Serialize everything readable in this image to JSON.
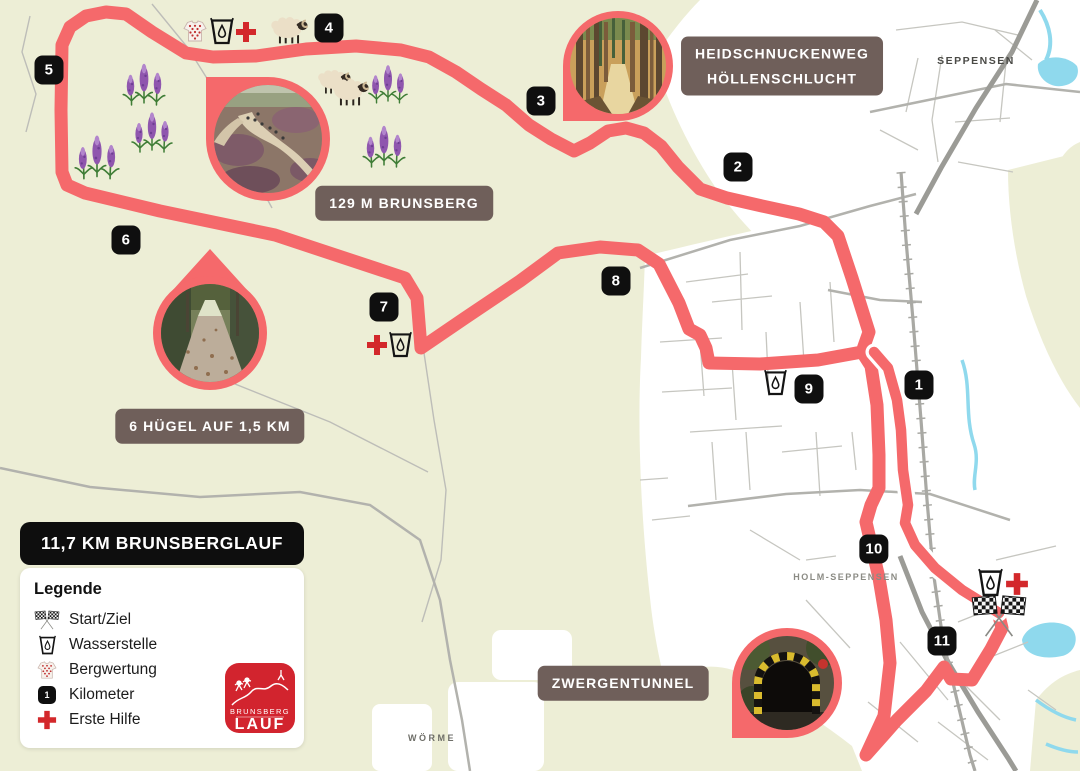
{
  "map": {
    "title_label": "11,7 KM BRUNSBERGLAUF",
    "legend": {
      "heading": "Legende",
      "km_sample": "1",
      "items": [
        {
          "icon": "start-finish-flags",
          "label": "Start/Ziel"
        },
        {
          "icon": "water-station",
          "label": "Wasserstelle"
        },
        {
          "icon": "mountain-jersey",
          "label": "Bergwertung"
        },
        {
          "icon": "kilometer-marker",
          "label": "Kilometer"
        },
        {
          "icon": "first-aid",
          "label": "Erste Hilfe"
        }
      ]
    },
    "logo": {
      "line1": "BRUNSBERG",
      "line2": "LAUF"
    },
    "labels": [
      {
        "name": "label-heidschnuckenweg",
        "lines": [
          "HEIDSCHNUCKENWEG",
          "HÖLLENSCHLUCHT"
        ],
        "cx": 782,
        "cy": 66
      },
      {
        "name": "label-brunsberg-summit",
        "lines": [
          "129 M BRUNSBERG"
        ],
        "cx": 404,
        "cy": 203
      },
      {
        "name": "label-huegel",
        "lines": [
          "6 HÜGEL AUF 1,5 KM"
        ],
        "cx": 210,
        "cy": 426
      },
      {
        "name": "label-zwergentunnel",
        "lines": [
          "ZWERGENTUNNEL"
        ],
        "cx": 623,
        "cy": 683
      }
    ],
    "places": [
      {
        "text": "SEPPENSEN",
        "x": 976,
        "y": 61,
        "size": 10.5,
        "spacing": 1.5,
        "color": "#4a4a46"
      },
      {
        "text": "HOLM-SEPPENSEN",
        "x": 846,
        "y": 577,
        "size": 9,
        "spacing": 1.5,
        "color": "#8b8b84"
      },
      {
        "text": "WÖRME",
        "x": 432,
        "y": 738,
        "size": 9,
        "spacing": 2.5,
        "color": "#6e6e68"
      }
    ],
    "km_markers": [
      {
        "label": "1",
        "x": 919,
        "y": 385
      },
      {
        "label": "2",
        "x": 738,
        "y": 167
      },
      {
        "label": "3",
        "x": 541,
        "y": 101
      },
      {
        "label": "4",
        "x": 329,
        "y": 28
      },
      {
        "label": "5",
        "x": 49,
        "y": 70
      },
      {
        "label": "6",
        "x": 126,
        "y": 240
      },
      {
        "label": "7",
        "x": 384,
        "y": 307
      },
      {
        "label": "8",
        "x": 616,
        "y": 281
      },
      {
        "label": "9",
        "x": 809,
        "y": 389
      },
      {
        "label": "10",
        "x": 874,
        "y": 549
      },
      {
        "label": "11",
        "x": 942,
        "y": 641
      }
    ],
    "icons": [
      {
        "type": "mountain-jersey",
        "x": 195,
        "y": 31,
        "s": 24
      },
      {
        "type": "water-station",
        "x": 222,
        "y": 31,
        "s": 24
      },
      {
        "type": "first-aid",
        "x": 246,
        "y": 32,
        "s": 22
      },
      {
        "type": "sheep",
        "x": 289,
        "y": 31,
        "s": 38
      },
      {
        "type": "sheep",
        "x": 334,
        "y": 82,
        "s": 34
      },
      {
        "type": "sheep",
        "x": 350,
        "y": 93,
        "s": 38
      },
      {
        "type": "lupine",
        "x": 144,
        "y": 80,
        "s": 46
      },
      {
        "type": "lupine",
        "x": 152,
        "y": 128,
        "s": 44
      },
      {
        "type": "lupine",
        "x": 97,
        "y": 152,
        "s": 48
      },
      {
        "type": "lupine",
        "x": 388,
        "y": 80,
        "s": 42
      },
      {
        "type": "lupine",
        "x": 384,
        "y": 142,
        "s": 46
      },
      {
        "type": "first-aid",
        "x": 377,
        "y": 345,
        "s": 22
      },
      {
        "type": "water-station",
        "x": 400,
        "y": 344,
        "s": 23
      },
      {
        "type": "water-station",
        "x": 775,
        "y": 382,
        "s": 23
      },
      {
        "type": "water-station",
        "x": 990,
        "y": 582,
        "s": 25
      },
      {
        "type": "first-aid",
        "x": 1017,
        "y": 584,
        "s": 24
      },
      {
        "type": "start-finish-flags",
        "x": 999,
        "y": 616,
        "s": 58
      }
    ],
    "route": {
      "color": "#F5696B",
      "loop": [
        [
          862,
          352
        ],
        [
          869,
          332
        ],
        [
          852,
          278
        ],
        [
          838,
          236
        ],
        [
          824,
          222
        ],
        [
          799,
          214
        ],
        [
          762,
          206
        ],
        [
          727,
          198
        ],
        [
          700,
          189
        ],
        [
          678,
          167
        ],
        [
          661,
          146
        ],
        [
          644,
          133
        ],
        [
          626,
          128
        ],
        [
          608,
          131
        ],
        [
          590,
          143
        ],
        [
          574,
          151
        ],
        [
          551,
          139
        ],
        [
          529,
          125
        ],
        [
          506,
          105
        ],
        [
          481,
          89
        ],
        [
          456,
          72
        ],
        [
          429,
          57
        ],
        [
          401,
          50
        ],
        [
          356,
          46
        ],
        [
          306,
          49
        ],
        [
          256,
          56
        ],
        [
          213,
          57
        ],
        [
          186,
          53
        ],
        [
          152,
          32
        ],
        [
          126,
          14
        ],
        [
          106,
          12
        ],
        [
          86,
          16
        ],
        [
          70,
          27
        ],
        [
          62,
          45
        ],
        [
          61,
          110
        ],
        [
          62,
          172
        ],
        [
          67,
          185
        ],
        [
          85,
          193
        ],
        [
          160,
          211
        ],
        [
          275,
          235
        ],
        [
          405,
          278
        ],
        [
          417,
          298
        ],
        [
          421,
          348
        ],
        [
          465,
          318
        ],
        [
          520,
          281
        ],
        [
          558,
          253
        ],
        [
          600,
          247
        ],
        [
          638,
          250
        ],
        [
          659,
          264
        ],
        [
          679,
          303
        ],
        [
          689,
          329
        ],
        [
          700,
          335
        ],
        [
          706,
          348
        ],
        [
          709,
          363
        ],
        [
          760,
          364
        ],
        [
          818,
          360
        ],
        [
          862,
          352
        ]
      ],
      "return_leg": [
        [
          862,
          352
        ],
        [
          871,
          366
        ],
        [
          877,
          405
        ],
        [
          879,
          455
        ],
        [
          879,
          488
        ],
        [
          871,
          505
        ],
        [
          866,
          522
        ],
        [
          872,
          548
        ],
        [
          879,
          578
        ],
        [
          886,
          620
        ],
        [
          890,
          663
        ],
        [
          884,
          716
        ],
        [
          866,
          755
        ],
        [
          897,
          720
        ],
        [
          926,
          691
        ],
        [
          944,
          667
        ],
        [
          951,
          679
        ],
        [
          972,
          680
        ],
        [
          991,
          649
        ],
        [
          1002,
          628
        ],
        [
          999,
          616
        ]
      ],
      "outbound": [
        [
          999,
          613
        ],
        [
          962,
          590
        ],
        [
          935,
          568
        ],
        [
          915,
          545
        ],
        [
          905,
          523
        ],
        [
          908,
          505
        ],
        [
          903,
          470
        ],
        [
          901,
          430
        ],
        [
          897,
          400
        ],
        [
          888,
          368
        ],
        [
          874,
          352
        ]
      ]
    },
    "colors": {
      "background": "#EDEED6",
      "route": "#F5696B",
      "label_bg": "#6F5F5A",
      "marker_bg": "#0F0F0F",
      "water": "#8FD9ED",
      "first_aid_red": "#D3282B",
      "logo_red": "#D2242E"
    }
  }
}
